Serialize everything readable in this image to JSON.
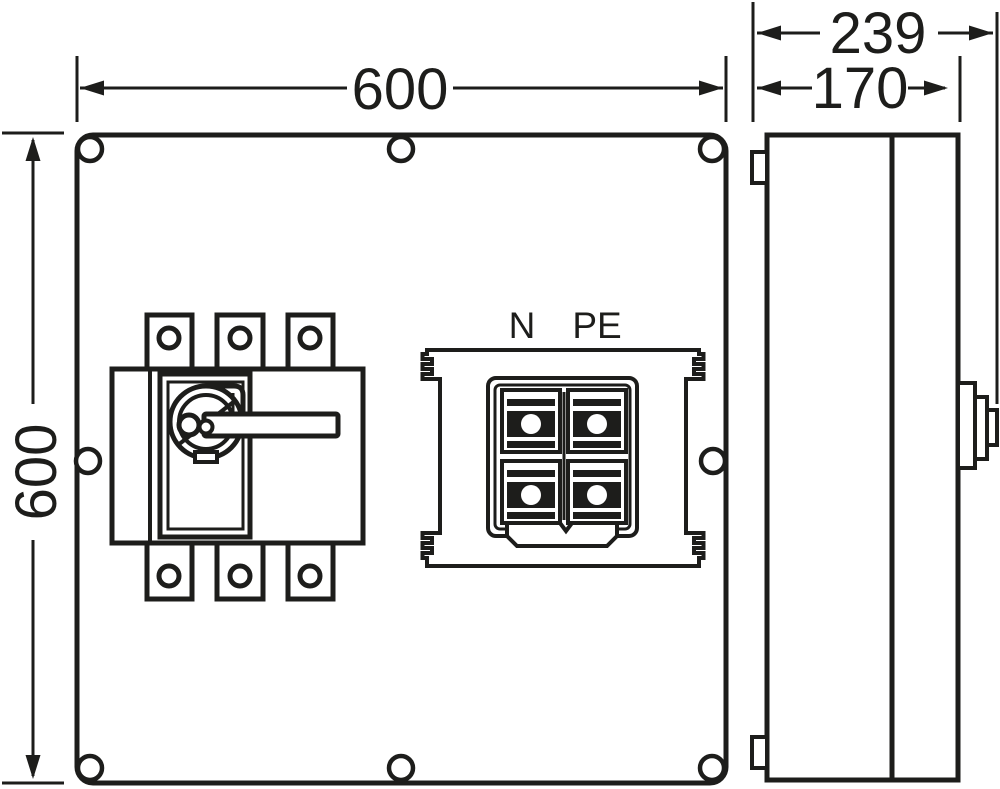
{
  "colors": {
    "line": "#1d1d1b",
    "background": "#ffffff"
  },
  "front_view": {
    "width_dimension_label": "600",
    "height_dimension_label": "600",
    "terminal_labels": {
      "neutral": "N",
      "protective_earth": "PE"
    }
  },
  "side_view": {
    "overall_depth_dimension_label": "239",
    "body_depth_dimension_label": "170"
  }
}
